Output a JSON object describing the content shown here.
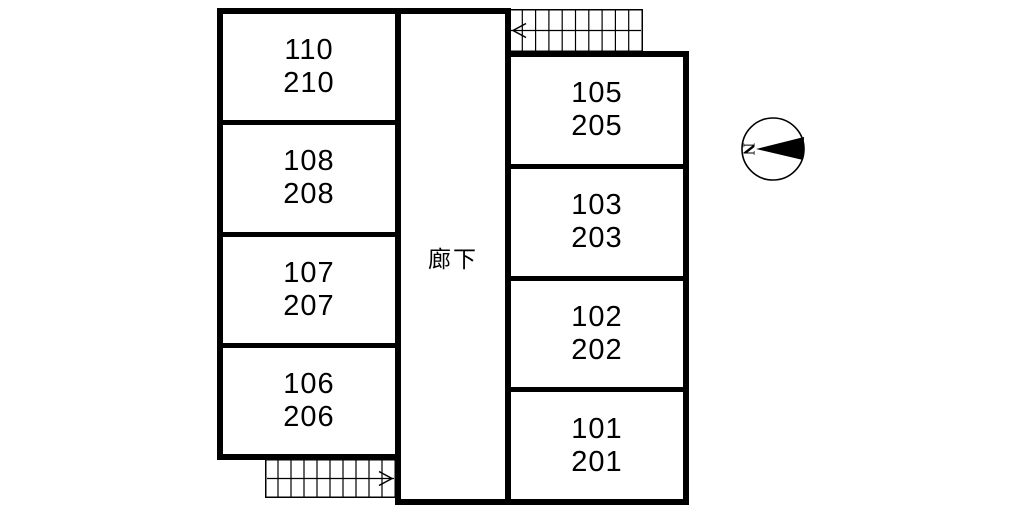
{
  "floorplan": {
    "corridor_label": "廊下",
    "left_rooms": [
      {
        "top": "110",
        "bottom": "210"
      },
      {
        "top": "108",
        "bottom": "208"
      },
      {
        "top": "107",
        "bottom": "207"
      },
      {
        "top": "106",
        "bottom": "206"
      }
    ],
    "right_rooms": [
      {
        "top": "105",
        "bottom": "205"
      },
      {
        "top": "103",
        "bottom": "203"
      },
      {
        "top": "102",
        "bottom": "202"
      },
      {
        "top": "101",
        "bottom": "201"
      }
    ],
    "stairs": {
      "top_right": {
        "arrow_direction": "left"
      },
      "bottom_left": {
        "arrow_direction": "right"
      }
    },
    "compass": {
      "label": "N",
      "pointing": "left"
    },
    "colors": {
      "line": "#000000",
      "background": "#ffffff"
    }
  }
}
